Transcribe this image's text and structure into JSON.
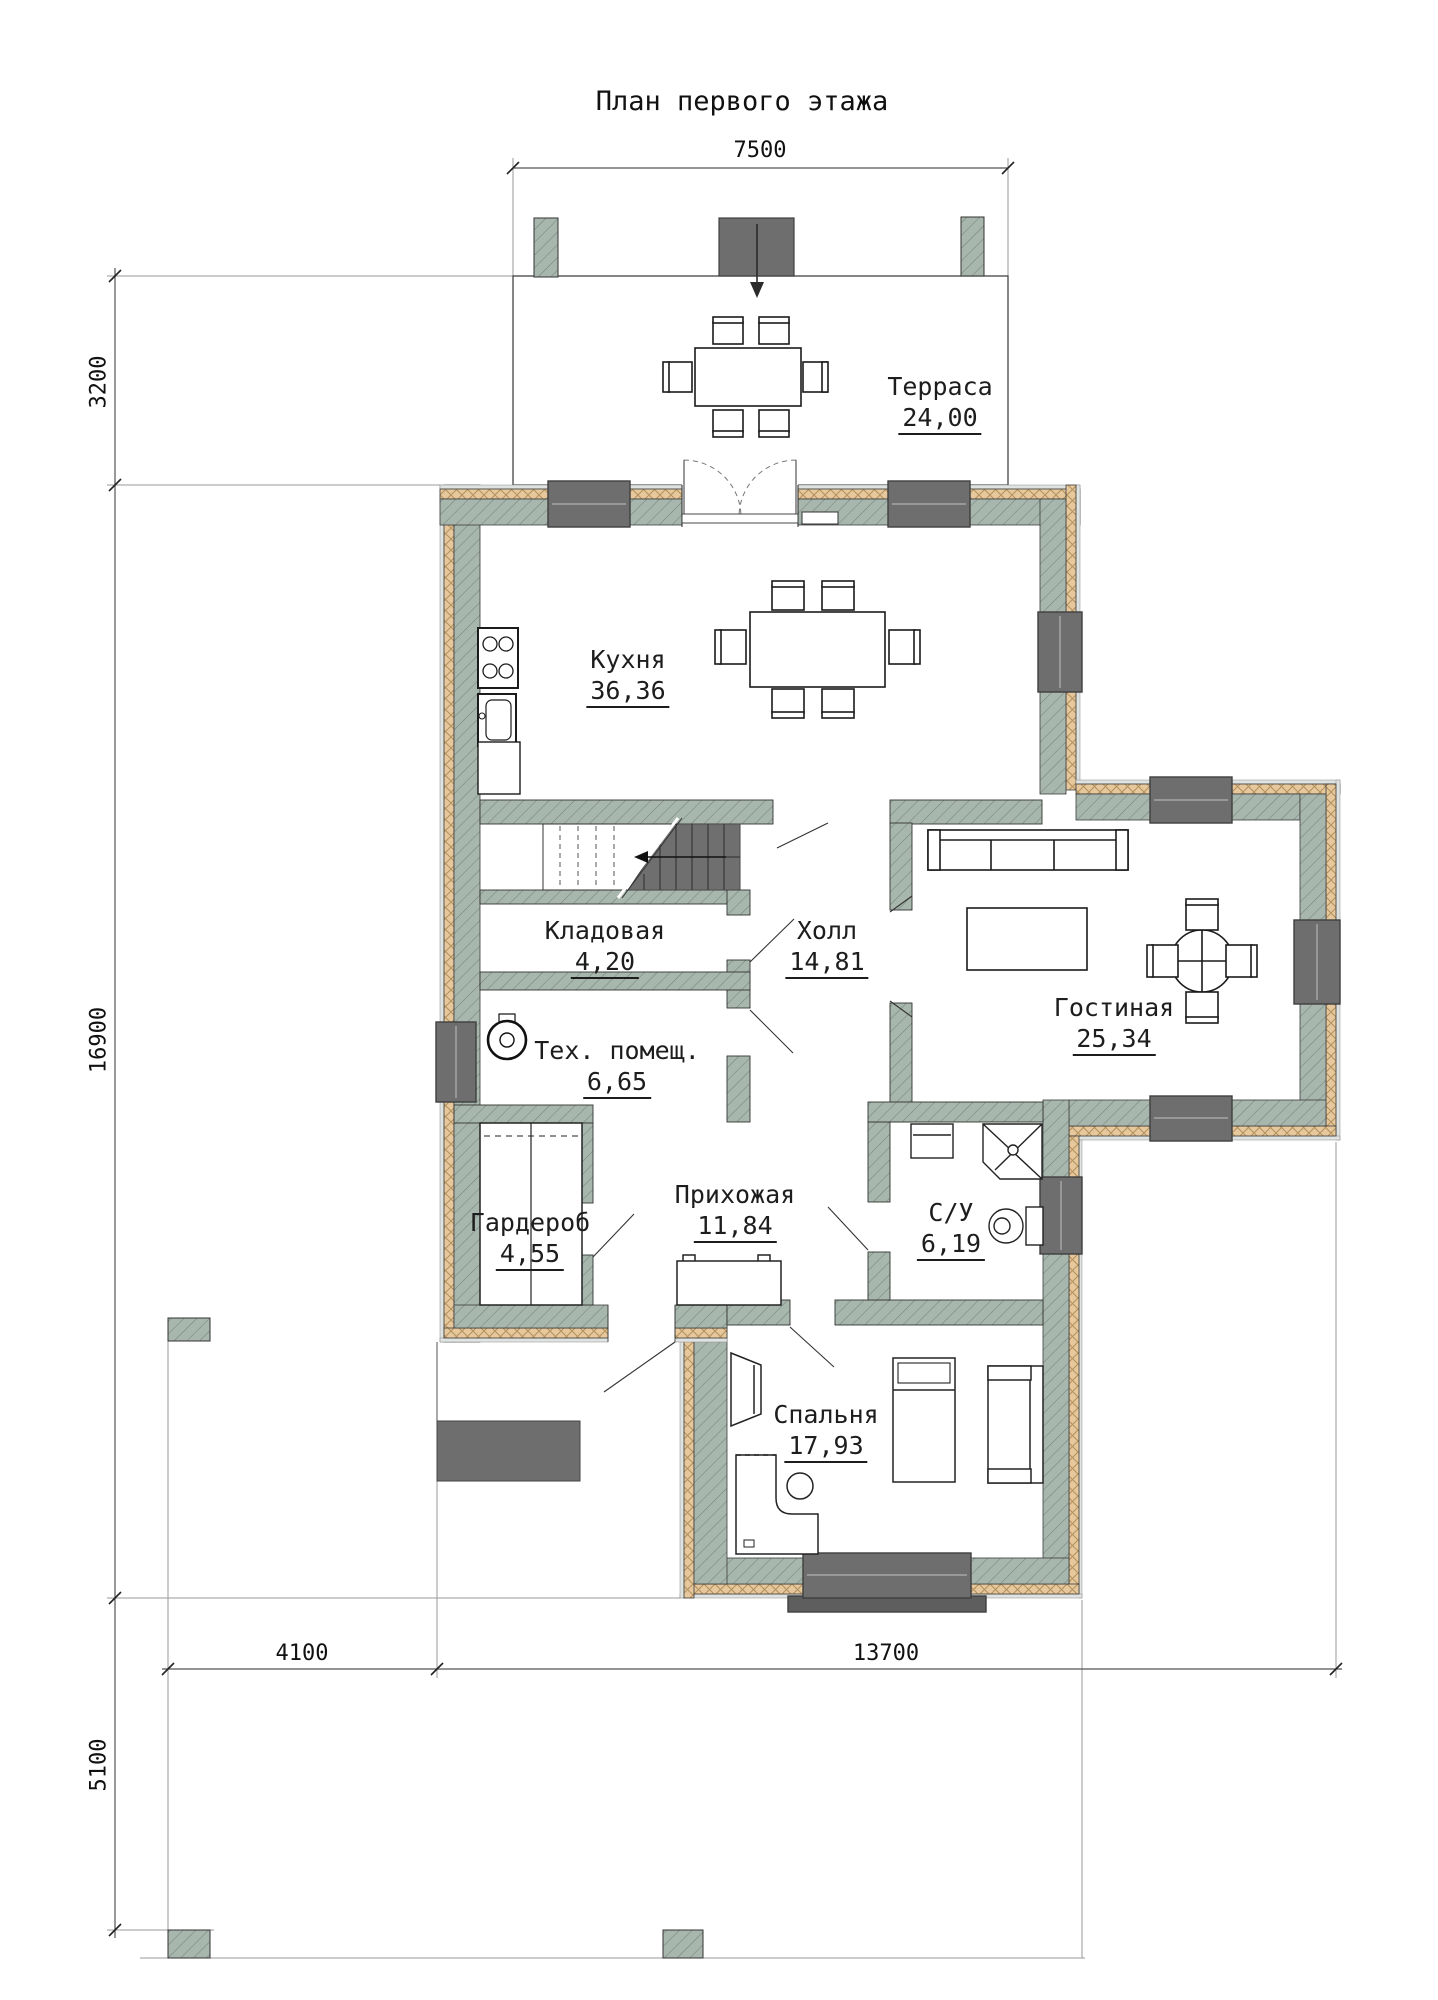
{
  "title": "План первого этажа",
  "rooms": {
    "terrace": {
      "name": "Терраса",
      "area": "24,00"
    },
    "kitchen": {
      "name": "Кухня",
      "area": "36,36"
    },
    "pantry": {
      "name": "Кладовая",
      "area": "4,20"
    },
    "hall": {
      "name": "Холл",
      "area": "14,81"
    },
    "living": {
      "name": "Гостиная",
      "area": "25,34"
    },
    "tech": {
      "name": "Тех. помещ.",
      "area": "6,65"
    },
    "wardrobe": {
      "name": "Гардероб",
      "area": "4,55"
    },
    "hallway": {
      "name": "Прихожая",
      "area": "11,84"
    },
    "wc": {
      "name": "С/У",
      "area": "6,19"
    },
    "bedroom": {
      "name": "Спальня",
      "area": "17,93"
    }
  },
  "dimensions": {
    "top": "7500",
    "left_top": "3200",
    "left_middle": "16900",
    "left_bottom": "5100",
    "bottom_left": "4100",
    "bottom_right": "13700"
  },
  "colors": {
    "wall_masonry": "#a8b7ae",
    "wall_insulation": "#e7c89d",
    "wall_finish": "#dfe3e1",
    "window_block": "#6e6e6e",
    "stair_flight": "#6f6f6f",
    "drawing_line": "#1b1b1b",
    "dimension_line": "#6f6f6f"
  }
}
